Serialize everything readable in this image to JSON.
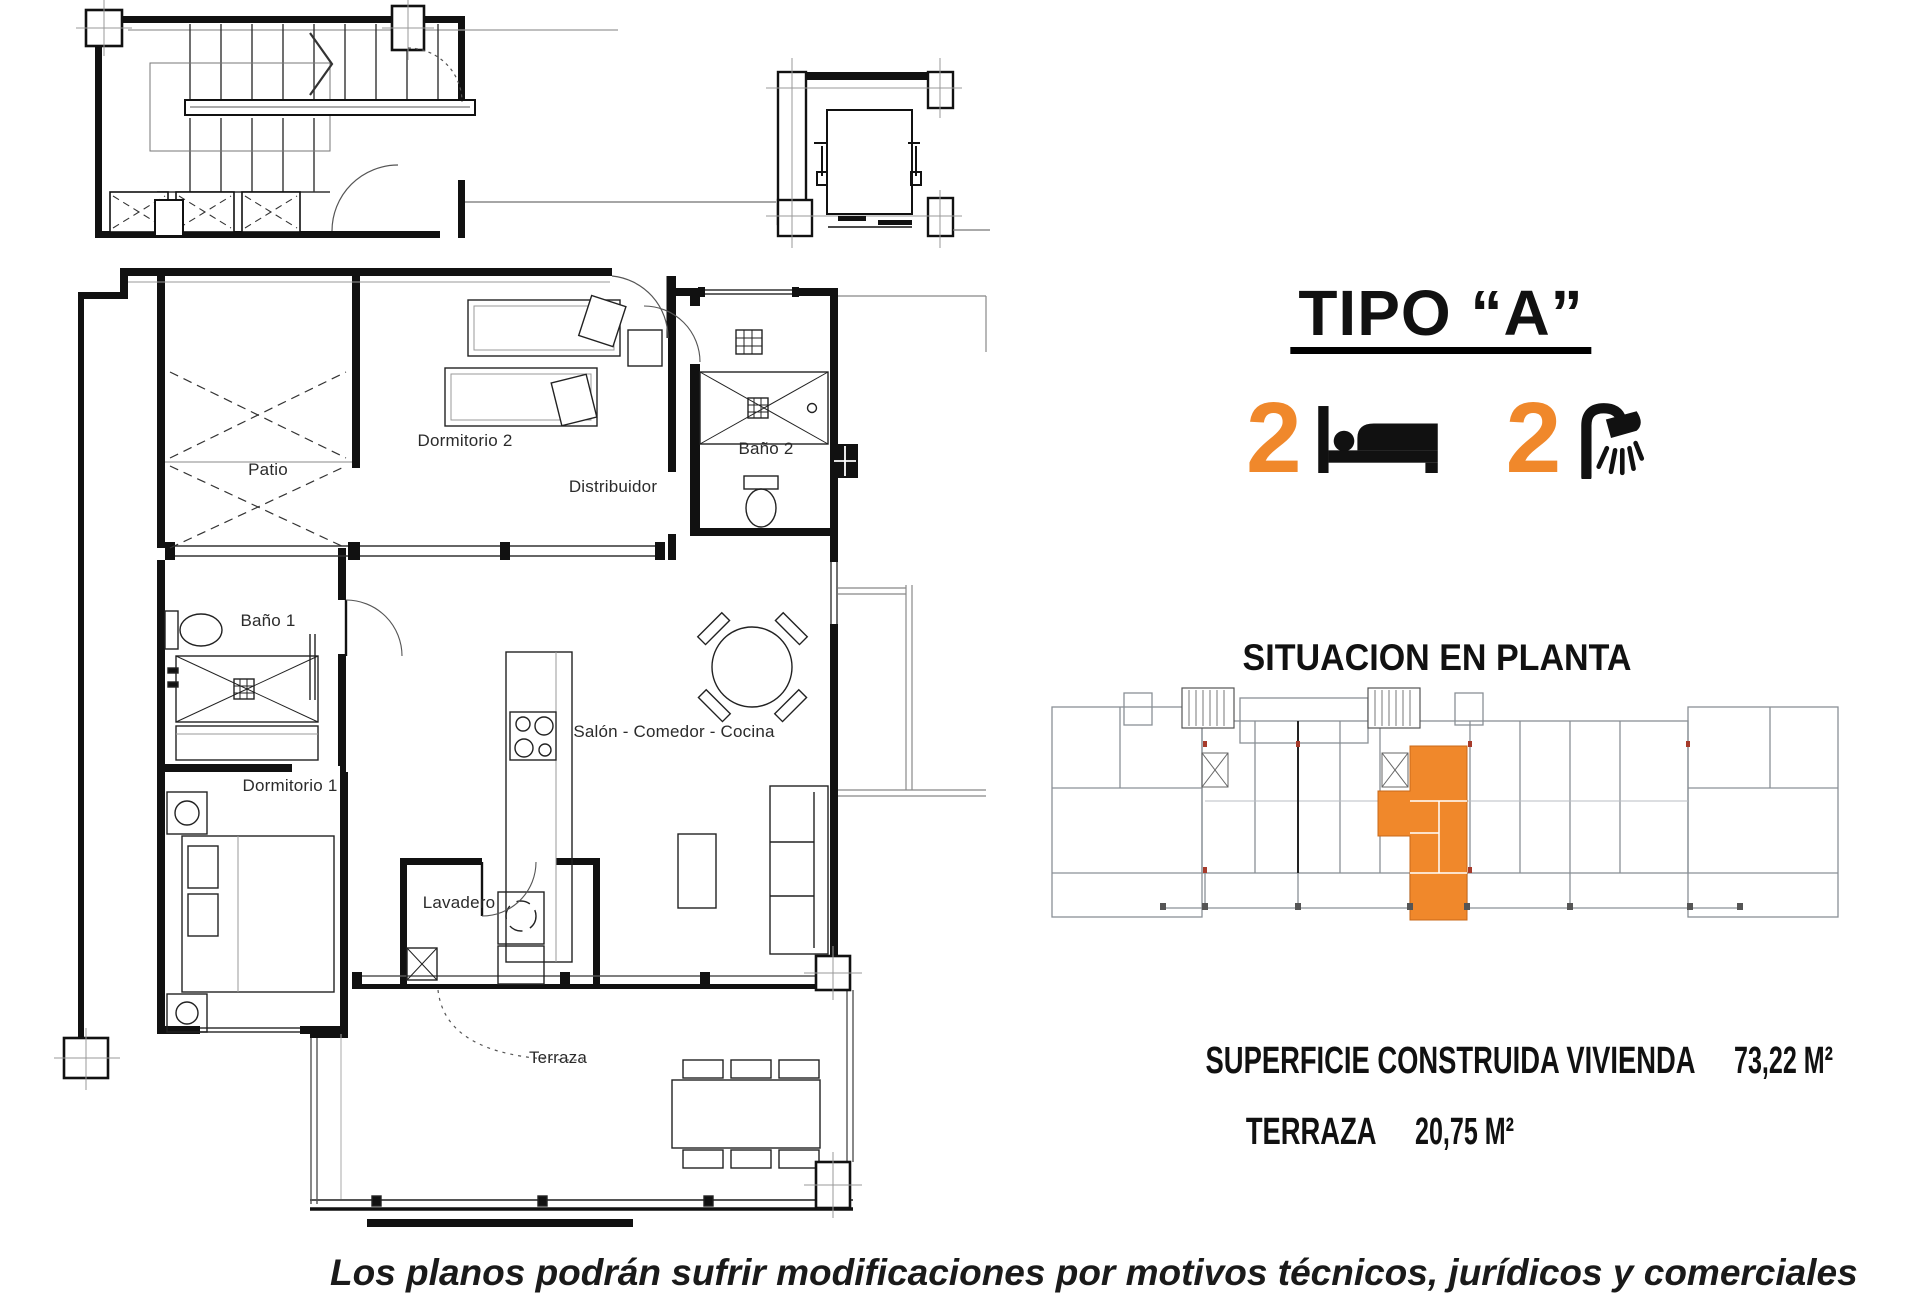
{
  "page": {
    "background": "#ffffff"
  },
  "colors": {
    "accent_orange": "#F0882B",
    "line_black": "#111111",
    "line_gray": "#888888"
  },
  "floor_plan": {
    "rooms": [
      {
        "id": "patio",
        "label": "Patio"
      },
      {
        "id": "dormitorio2",
        "label": "Dormitorio 2"
      },
      {
        "id": "bano2",
        "label": "Baño 2"
      },
      {
        "id": "distribuidor",
        "label": "Distribuidor"
      },
      {
        "id": "bano1",
        "label": "Baño 1"
      },
      {
        "id": "dormitorio1",
        "label": "Dormitorio 1"
      },
      {
        "id": "salon",
        "label": "Salón - Comedor - Cocina"
      },
      {
        "id": "lavadero",
        "label": "Lavadero"
      },
      {
        "id": "terraza",
        "label": "Terraza"
      }
    ]
  },
  "panel": {
    "title": "TIPO “A”",
    "bedrooms": {
      "count": "2",
      "icon": "bed-icon"
    },
    "bathrooms": {
      "count": "2",
      "icon": "shower-icon"
    },
    "situacion_title": "SITUACION EN PLANTA",
    "areas": [
      {
        "label": "SUPERFICIE CONSTRUIDA VIVIENDA",
        "value": "73,22 M²"
      },
      {
        "label": "TERRAZA",
        "value": "20,75 M²"
      }
    ]
  },
  "footer": {
    "disclaimer": "Los planos podrán sufrir modificaciones por motivos técnicos, jurídicos y comerciales"
  }
}
